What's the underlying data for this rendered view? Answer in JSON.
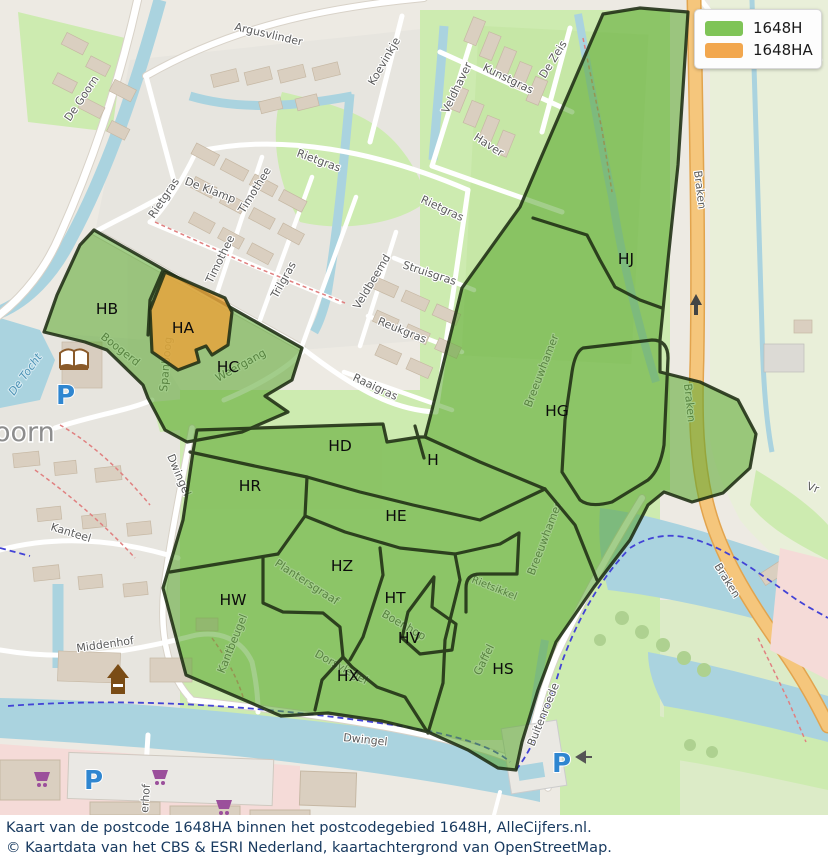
{
  "legend": {
    "items": [
      {
        "label": "1648H",
        "color": "#7fc457"
      },
      {
        "label": "1648HA",
        "color": "#f2a74e"
      }
    ]
  },
  "regions": [
    "HB",
    "HA",
    "HC",
    "HD",
    "H",
    "HR",
    "HE",
    "HZ",
    "HW",
    "HT",
    "HV",
    "HX",
    "HS",
    "HG",
    "HJ"
  ],
  "streets": [
    "Argusvlinder",
    "De Goorn",
    "Koevinkje",
    "Veldhaver",
    "Kunstgras",
    "De Zeis",
    "Haver",
    "Rietgras",
    "De Klamp",
    "Rietgras",
    "Timothee",
    "Timothee",
    "Trilgras",
    "Struisgras",
    "Veldbeemd",
    "Reukgras",
    "Raaigras",
    "Rietgras",
    "Braken",
    "Braken",
    "Braken",
    "Dwingel",
    "Kanteel",
    "Middenhof",
    "Boogerd",
    "Spanboog",
    "Weergang",
    "Breeuwhamer",
    "Breeuwhamer",
    "Plantersgraaf",
    "Kantbeugel",
    "Boenhop",
    "Dorsvlegel",
    "Gaffel",
    "Rietsikkel",
    "Buitenroede",
    "De Tocht",
    "Dwingel"
  ],
  "fragments": {
    "town": "oorn",
    "erhof": "erhof",
    "vr": "Vr"
  },
  "icons": {
    "parking": "P"
  },
  "overlay_colors": {
    "postcode_green": "#57a52b",
    "postcode_orange": "#e8a33c",
    "border": "#1f2e14"
  },
  "caption": {
    "line1": "Kaart van de postcode 1648HA binnen het postcodegebied 1648H, AlleCijfers.nl.",
    "line2": "© Kaartdata van het CBS & ESRI Nederland, kaartachtergrond van OpenStreetMap."
  }
}
